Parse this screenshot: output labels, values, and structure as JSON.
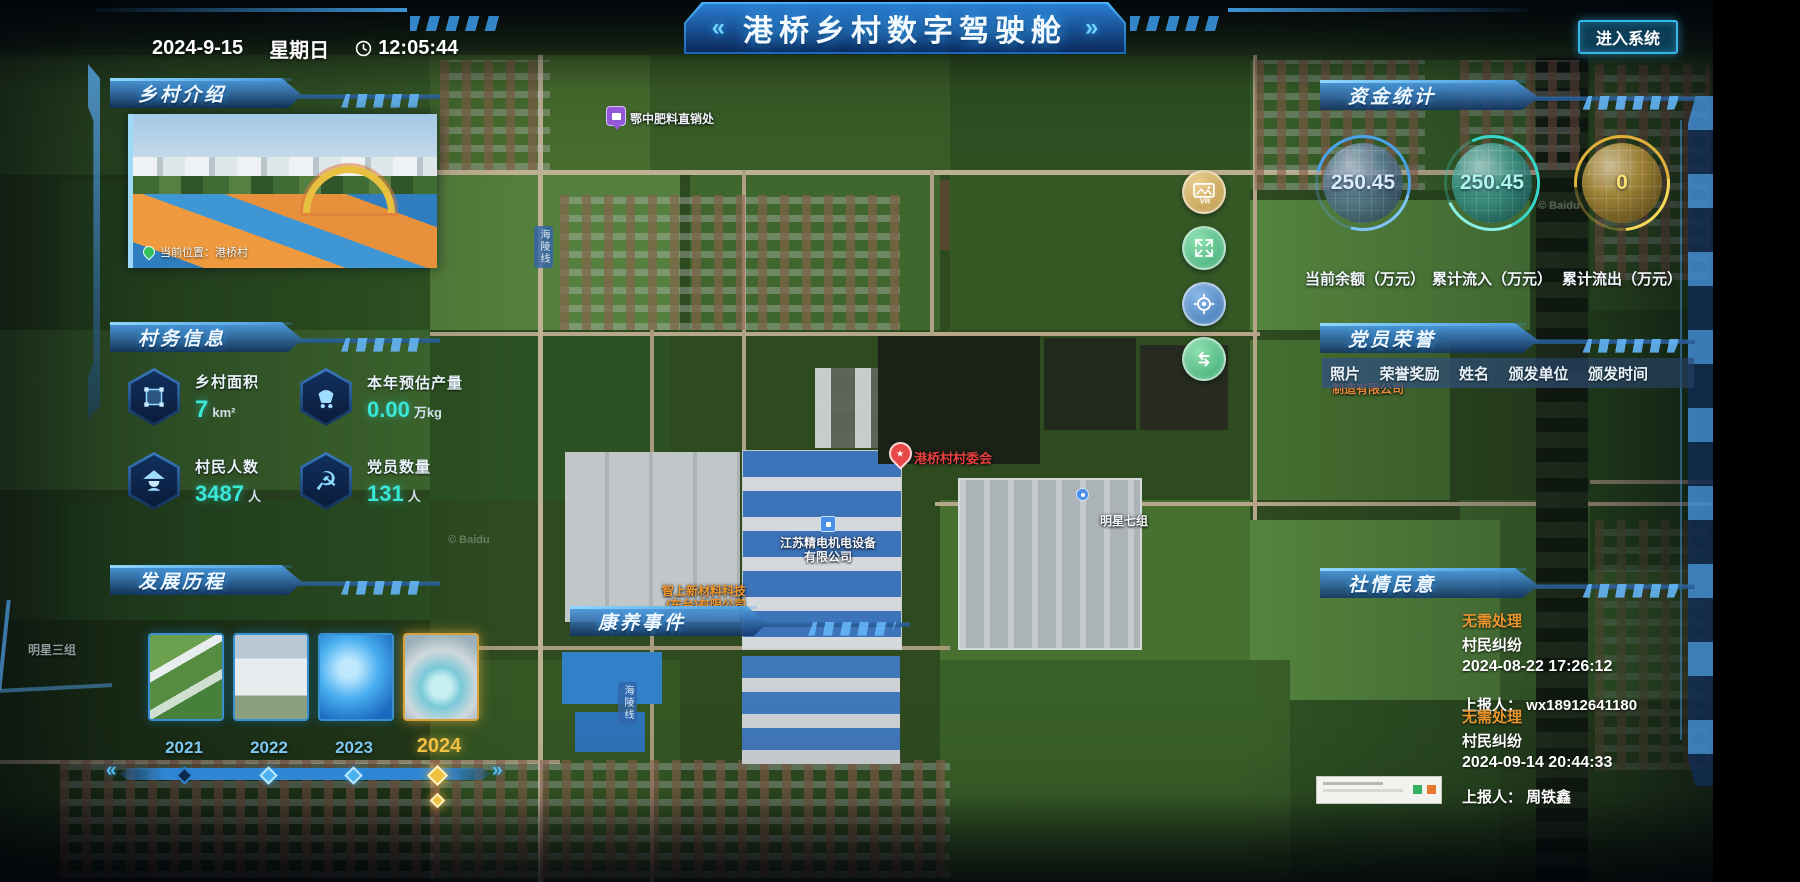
{
  "header": {
    "date": "2024-9-15",
    "weekday": "星期日",
    "time": "12:05:44",
    "title": "港桥乡村数字驾驶舱",
    "chevron_left": "«",
    "chevron_right": "»",
    "enter_button": "进入系统"
  },
  "intro_panel": {
    "title": "乡村介绍",
    "location_badge": "当前位置：港桥村"
  },
  "affairs_panel": {
    "title": "村务信息",
    "stats": [
      {
        "icon": "area-icon",
        "label": "乡村面积",
        "value": "7",
        "unit": "km²"
      },
      {
        "icon": "cart-icon",
        "label": "本年预估产量",
        "value": "0.00",
        "unit": "万kg"
      },
      {
        "icon": "villager-icon",
        "label": "村民人数",
        "value": "3487",
        "unit": "人"
      },
      {
        "icon": "party-icon",
        "label": "党员数量",
        "value": "131",
        "unit": "人",
        "glyph": "☭"
      }
    ]
  },
  "history_panel": {
    "title": "发展历程",
    "years": [
      "2021",
      "2022",
      "2023",
      "2024"
    ],
    "active_year": "2024"
  },
  "funds_panel": {
    "title": "资金统计",
    "gauges": [
      {
        "value": "250.45",
        "label": "当前余额（万元）",
        "color": "#4aa3e8"
      },
      {
        "value": "250.45",
        "label": "累计流入（万元）",
        "color": "#38d6c8"
      },
      {
        "value": "0",
        "label": "累计流出（万元）",
        "color": "#e0b03a"
      }
    ]
  },
  "honors_panel": {
    "title": "党员荣誉",
    "columns": [
      "照片",
      "荣誉奖励",
      "姓名",
      "颁发单位",
      "颁发时间"
    ]
  },
  "sentiment_panel": {
    "title": "社情民意",
    "items": [
      {
        "status": "无需处理",
        "category": "村民纠纷",
        "time": "2024-08-22 17:26:12",
        "reporter": "上报人： wx18912641180"
      },
      {
        "status": "无需处理",
        "category": "村民纠纷",
        "time": "2024-09-14 20:44:33",
        "reporter": "上报人： 周铁鑫"
      }
    ]
  },
  "health_panel": {
    "title": "康养事件"
  },
  "map": {
    "labels": {
      "fertilizer": "鄂中肥料直销处",
      "committee": "港桥村村委会",
      "factory1_line1": "江苏精电机电设备",
      "factory1_line2": "有限公司",
      "factory2_line1": "智上新材料科技",
      "factory2_line2": "(东台)有限公司",
      "group7": "明星七组",
      "group3": "明星三组",
      "partial_company": "制造有限公司",
      "road": "海陵线",
      "watermark": "© Baidu"
    },
    "tools": [
      "vr-view",
      "fullscreen",
      "locate",
      "layer-swap"
    ]
  },
  "colors": {
    "accent_blue": "#35b8e8",
    "accent_cyan": "#3ae8d8",
    "gold": "#f0c040",
    "status_orange": "#e8952e",
    "balance_blue": "#4aa3e8",
    "inflow_teal": "#38d6c8",
    "outflow_gold": "#e0b03a"
  }
}
